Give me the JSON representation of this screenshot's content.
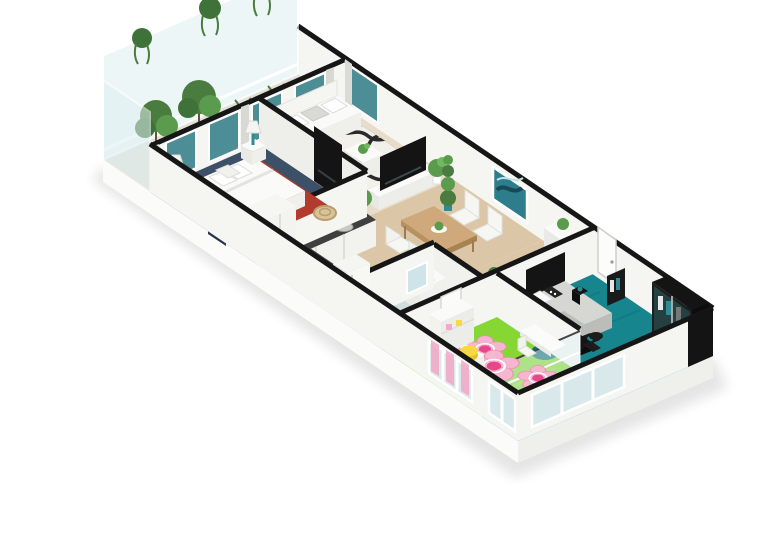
{
  "scene": {
    "title": "3D isometric cutaway floor plan render of a three-bedroom apartment",
    "view": "isometric",
    "background": "#ffffff"
  },
  "palette": {
    "wall": "#f5f5f2",
    "wall_shade": "#eeeeea",
    "wall_cap": "#161616",
    "plinth": "#fbfbfa",
    "plinth_side": "#efefec",
    "balcony_floor": "#e3e0d8",
    "living_floor": "#e8ddca",
    "wood_floor": "#dbc6a8",
    "tile_floor": "#b8b5aa",
    "master_carpet": "#3c5168",
    "master_rug": "#b23b2e",
    "kids_carpet": "#86d733",
    "teal_carpet": "#17858e",
    "flower_petal": "#f6b6cf",
    "flower_core": "#e8478b",
    "curtain_pink": "#f2a6c6",
    "glass": "#dff0f2",
    "window_teal": "#4d8d96",
    "accent_teal": "#2e8b94",
    "plant_green": "#5a9b4d",
    "plant_dark": "#3f7239",
    "art_teal": "#2e7d8c",
    "counter_dark": "#3f3f3f",
    "furniture_white": "#fafaf8",
    "furniture_black": "#141414",
    "bed_gray": "#d6d6d3",
    "pouf_yellow": "#f6d93c",
    "table_wood": "#cfa97b",
    "rug_white": "#f2f0ea",
    "rug_black": "#1a1a1a"
  },
  "rooms": [
    {
      "name": "balcony",
      "floor": "light gray",
      "items": [
        "glass balustrade",
        "hanging plants",
        "tall potted trees",
        "teal planter pots"
      ]
    },
    {
      "name": "master-bedroom",
      "floor": "navy carpet",
      "items": [
        "double bed with white duvet",
        "four pillows",
        "two nightstands",
        "two teal lamps",
        "red area rug",
        "rattan chair",
        "white wardrobe",
        "wall tv"
      ]
    },
    {
      "name": "living-room",
      "floor": "light wood",
      "items": [
        "white sofa with cushions",
        "black-white pattern rug",
        "coffee table with plant",
        "tv console with tv",
        "two potted plants",
        "window curtains"
      ]
    },
    {
      "name": "kitchen",
      "floor": "wood",
      "items": [
        "white l-shaped cabinets",
        "dark countertop",
        "sink",
        "cooktop",
        "tall fridge cabinet"
      ]
    },
    {
      "name": "dining-area",
      "floor": "wood",
      "items": [
        "wooden dining table",
        "four white chairs",
        "plant centerpiece",
        "teal wall artwork",
        "columnar plants"
      ]
    },
    {
      "name": "bathroom",
      "floor": "gray tile",
      "items": [
        "vanity with sink",
        "mirror",
        "glass shower enclosure",
        "toilet"
      ]
    },
    {
      "name": "hallway",
      "floor": "wood",
      "items": [
        "white console with plant",
        "columnar plant",
        "white interior doors"
      ]
    },
    {
      "name": "kids-room",
      "floor": "green carpet",
      "items": [
        "three pink flower rugs",
        "toddler bed with pink blanket",
        "white shelving",
        "white desk and chair",
        "yellow pouf",
        "pink window curtains"
      ]
    },
    {
      "name": "teen-bedroom",
      "floor": "teal carpet",
      "items": [
        "gray bed with black headboard",
        "patterned pillows",
        "black desk and chair",
        "black glass-front wardrobe",
        "open clothes rack",
        "black side table",
        "glass partition",
        "corner windows"
      ]
    }
  ]
}
